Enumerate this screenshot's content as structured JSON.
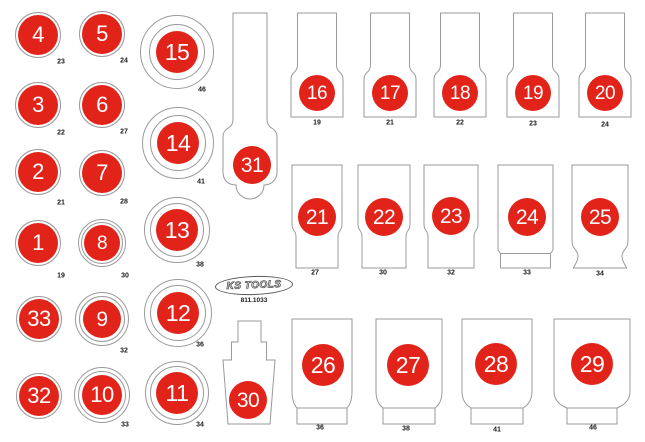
{
  "brand": {
    "logo_text": "KS TOOLS",
    "part_number": "811.1033"
  },
  "colors": {
    "red": "#e2231a",
    "outline": "#9a9a9a",
    "label": "#1a1a1a",
    "logo_outline": "#555555"
  },
  "left_circles": [
    {
      "number": "4",
      "size": "23",
      "cx": 38,
      "cy": 35,
      "r": 20,
      "rings": [
        23
      ],
      "label_pos": [
        61,
        62
      ]
    },
    {
      "number": "5",
      "size": "24",
      "cx": 102,
      "cy": 34,
      "r": 20,
      "rings": [
        23
      ],
      "label_pos": [
        124,
        61
      ]
    },
    {
      "number": "15",
      "size": "46",
      "cx": 177,
      "cy": 52,
      "r": 21,
      "rings": [
        28,
        37
      ],
      "label_pos": [
        202,
        90
      ]
    },
    {
      "number": "3",
      "size": "22",
      "cx": 38,
      "cy": 105,
      "r": 20,
      "rings": [
        23
      ],
      "label_pos": [
        61,
        133
      ]
    },
    {
      "number": "6",
      "size": "27",
      "cx": 102,
      "cy": 105,
      "r": 20,
      "rings": [
        23
      ],
      "label_pos": [
        124,
        132
      ]
    },
    {
      "number": "14",
      "size": "41",
      "cx": 178,
      "cy": 143,
      "r": 21,
      "rings": [
        28,
        36
      ],
      "label_pos": [
        201,
        182
      ]
    },
    {
      "number": "2",
      "size": "21",
      "cx": 38,
      "cy": 172,
      "r": 20,
      "rings": [
        23
      ],
      "label_pos": [
        61,
        203
      ]
    },
    {
      "number": "7",
      "size": "28",
      "cx": 102,
      "cy": 173,
      "r": 20,
      "rings": [
        23
      ],
      "label_pos": [
        124,
        202
      ]
    },
    {
      "number": "13",
      "size": "38",
      "cx": 177,
      "cy": 230,
      "r": 21,
      "rings": [
        27,
        33
      ],
      "label_pos": [
        200,
        265
      ]
    },
    {
      "number": "1",
      "size": "19",
      "cx": 38,
      "cy": 243,
      "r": 20,
      "rings": [
        23
      ],
      "label_pos": [
        61,
        276
      ]
    },
    {
      "number": "8",
      "size": "30",
      "cx": 102,
      "cy": 243,
      "r": 18,
      "rings": [
        21,
        24
      ],
      "label_pos": [
        125,
        276
      ]
    },
    {
      "number": "33",
      "size": "",
      "cx": 39,
      "cy": 319,
      "r": 20,
      "rings": [
        23
      ],
      "label_pos": null
    },
    {
      "number": "9",
      "size": "32",
      "cx": 102,
      "cy": 319,
      "r": 19,
      "rings": [
        23,
        27
      ],
      "label_pos": [
        124,
        351
      ]
    },
    {
      "number": "12",
      "size": "36",
      "cx": 178,
      "cy": 313,
      "r": 21,
      "rings": [
        28,
        34
      ],
      "label_pos": [
        200,
        345
      ]
    },
    {
      "number": "32",
      "size": "",
      "cx": 39,
      "cy": 396,
      "r": 20,
      "rings": [
        23
      ],
      "label_pos": null
    },
    {
      "number": "10",
      "size": "33",
      "cx": 102,
      "cy": 395,
      "r": 20,
      "rings": [
        24,
        28
      ],
      "label_pos": [
        125,
        425
      ]
    },
    {
      "number": "11",
      "size": "34",
      "cx": 177,
      "cy": 393,
      "r": 21,
      "rings": [
        27,
        32
      ],
      "label_pos": [
        200,
        425
      ]
    }
  ],
  "sockets": [
    {
      "number": "16",
      "size": "19",
      "shape": "step",
      "x": 291,
      "y": 13,
      "w": 52,
      "h": 104,
      "circle": [
        26,
        80
      ],
      "r": 18,
      "label_pos": [
        317,
        123
      ]
    },
    {
      "number": "17",
      "size": "21",
      "shape": "step",
      "x": 364,
      "y": 13,
      "w": 52,
      "h": 104,
      "circle": [
        26,
        80
      ],
      "r": 18,
      "label_pos": [
        390,
        123
      ]
    },
    {
      "number": "18",
      "size": "22",
      "shape": "step",
      "x": 434,
      "y": 13,
      "w": 52,
      "h": 104,
      "circle": [
        26,
        80
      ],
      "r": 18,
      "label_pos": [
        460,
        123
      ]
    },
    {
      "number": "19",
      "size": "23",
      "shape": "step",
      "x": 507,
      "y": 13,
      "w": 52,
      "h": 104,
      "circle": [
        26,
        80
      ],
      "r": 18,
      "label_pos": [
        533,
        124
      ]
    },
    {
      "number": "20",
      "size": "24",
      "shape": "step",
      "x": 579,
      "y": 13,
      "w": 52,
      "h": 104,
      "circle": [
        26,
        80
      ],
      "r": 18,
      "label_pos": [
        605,
        125
      ]
    },
    {
      "number": "21",
      "size": "27",
      "shape": "deep",
      "x": 292,
      "y": 165,
      "w": 50,
      "h": 103,
      "circle": [
        25,
        52
      ],
      "r": 19,
      "label_pos": [
        315,
        273
      ]
    },
    {
      "number": "22",
      "size": "30",
      "shape": "deep",
      "x": 358,
      "y": 165,
      "w": 52,
      "h": 103,
      "circle": [
        26,
        52
      ],
      "r": 19,
      "label_pos": [
        383,
        273
      ]
    },
    {
      "number": "23",
      "size": "32",
      "shape": "deep",
      "x": 424,
      "y": 165,
      "w": 54,
      "h": 103,
      "circle": [
        27,
        51
      ],
      "r": 19,
      "label_pos": [
        451,
        273
      ]
    },
    {
      "number": "24",
      "size": "33",
      "shape": "taperband",
      "x": 498,
      "y": 165,
      "w": 55,
      "h": 103,
      "circle": [
        29,
        52
      ],
      "r": 19,
      "label_pos": [
        527,
        273
      ]
    },
    {
      "number": "25",
      "size": "34",
      "shape": "waistflare",
      "x": 572,
      "y": 165,
      "w": 56,
      "h": 103,
      "circle": [
        28,
        52
      ],
      "r": 19,
      "label_pos": [
        600,
        274
      ]
    },
    {
      "number": "26",
      "size": "36",
      "shape": "notch",
      "x": 292,
      "y": 319,
      "w": 60,
      "h": 105,
      "inset": 5,
      "circle": [
        31,
        46
      ],
      "r": 21,
      "label_pos": [
        320,
        428
      ]
    },
    {
      "number": "27",
      "size": "38",
      "shape": "notch",
      "x": 376,
      "y": 319,
      "w": 66,
      "h": 105,
      "inset": 7,
      "circle": [
        32,
        46
      ],
      "r": 21,
      "label_pos": [
        406,
        429
      ]
    },
    {
      "number": "28",
      "size": "41",
      "shape": "notch",
      "x": 462,
      "y": 319,
      "w": 70,
      "h": 105,
      "inset": 9,
      "circle": [
        34,
        45
      ],
      "r": 21,
      "label_pos": [
        497,
        430
      ]
    },
    {
      "number": "29",
      "size": "46",
      "shape": "notch",
      "x": 554,
      "y": 319,
      "w": 76,
      "h": 105,
      "inset": 13,
      "circle": [
        38,
        45
      ],
      "r": 21,
      "label_pos": [
        593,
        428
      ]
    }
  ],
  "tools": [
    {
      "number": "31",
      "shape": "ratchet",
      "x": 223,
      "y": 13,
      "w": 54,
      "h": 190,
      "circle": [
        29,
        152
      ],
      "r": 19
    },
    {
      "number": "30",
      "shape": "adapter",
      "x": 223,
      "y": 321,
      "w": 52,
      "h": 103,
      "circle": [
        25,
        79
      ],
      "r": 19
    }
  ]
}
